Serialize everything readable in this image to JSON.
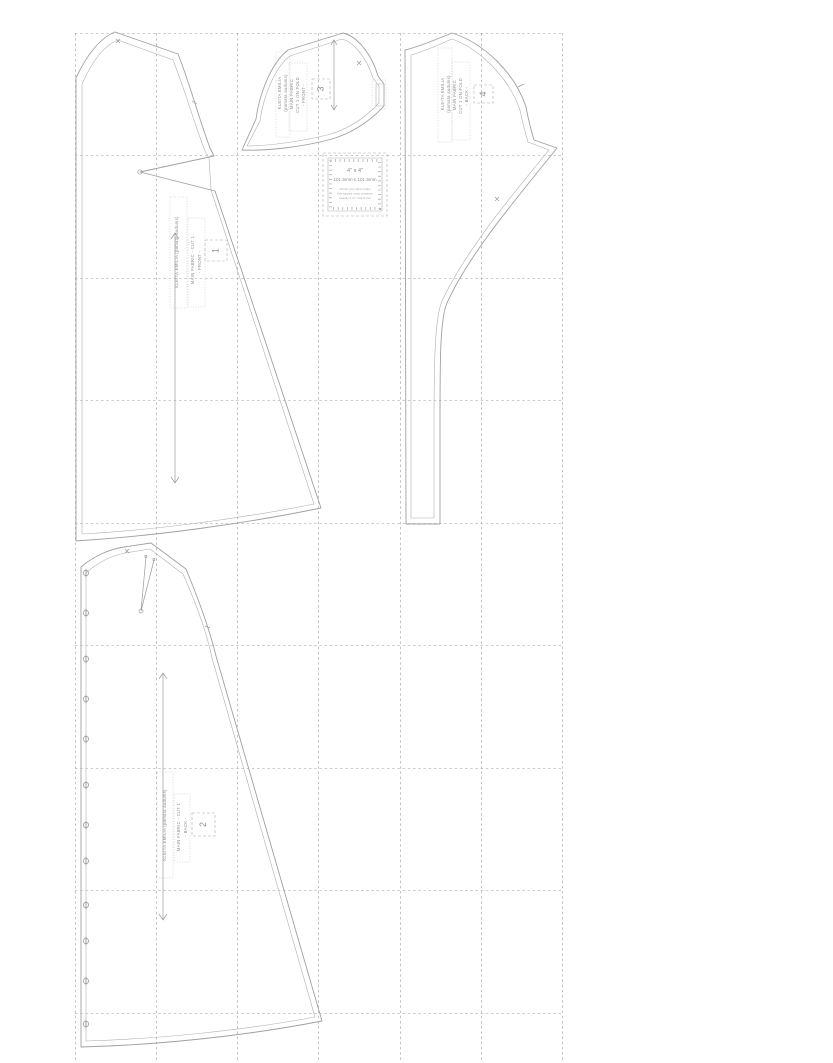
{
  "colors": {
    "background": "#ffffff",
    "pattern_line": "#a0a0a0",
    "grid_line": "#9b9b9b",
    "label_text": "#8d8d8d"
  },
  "test_square": {
    "title": "4\" x 4\"",
    "dimensions": "101.5mm x 101.5mm",
    "note_line1": "Check your print scale:",
    "note_line2": "this square must measure",
    "note_line3": "exactly 4 in / 101.5 mm"
  },
  "pieces": {
    "p1": {
      "number": "1",
      "title": "KLEITA EMILIA (pamata audums)",
      "fabric": "MAIN FABRIC - CUT 1",
      "part": "- FRONT -"
    },
    "p2": {
      "number": "2",
      "title": "KLEITA EMILIA (pamata audums)",
      "fabric": "MAIN FABRIC - CUT 1",
      "part": "- BACK -"
    },
    "p3": {
      "number": "3",
      "line1": "KLEITA EMILIA",
      "line2": "(pamata audums)",
      "line3": "MAIN FABRIC",
      "line4": "CUT 1 ON FOLD",
      "line5": "- FRONT -"
    },
    "p4": {
      "number": "4",
      "line1": "KLEITA EMILIA",
      "line2": "(pamata audums)",
      "line3": "MAIN FABRIC",
      "line4": "CUT 1 ON FOLD",
      "line5": "- BACK -"
    }
  },
  "marks": {
    "buttons": {
      "x": 86,
      "r": 2.6,
      "ys": [
        573,
        613,
        659,
        699,
        739,
        785,
        825,
        861,
        905,
        941,
        981,
        1024
      ]
    }
  }
}
